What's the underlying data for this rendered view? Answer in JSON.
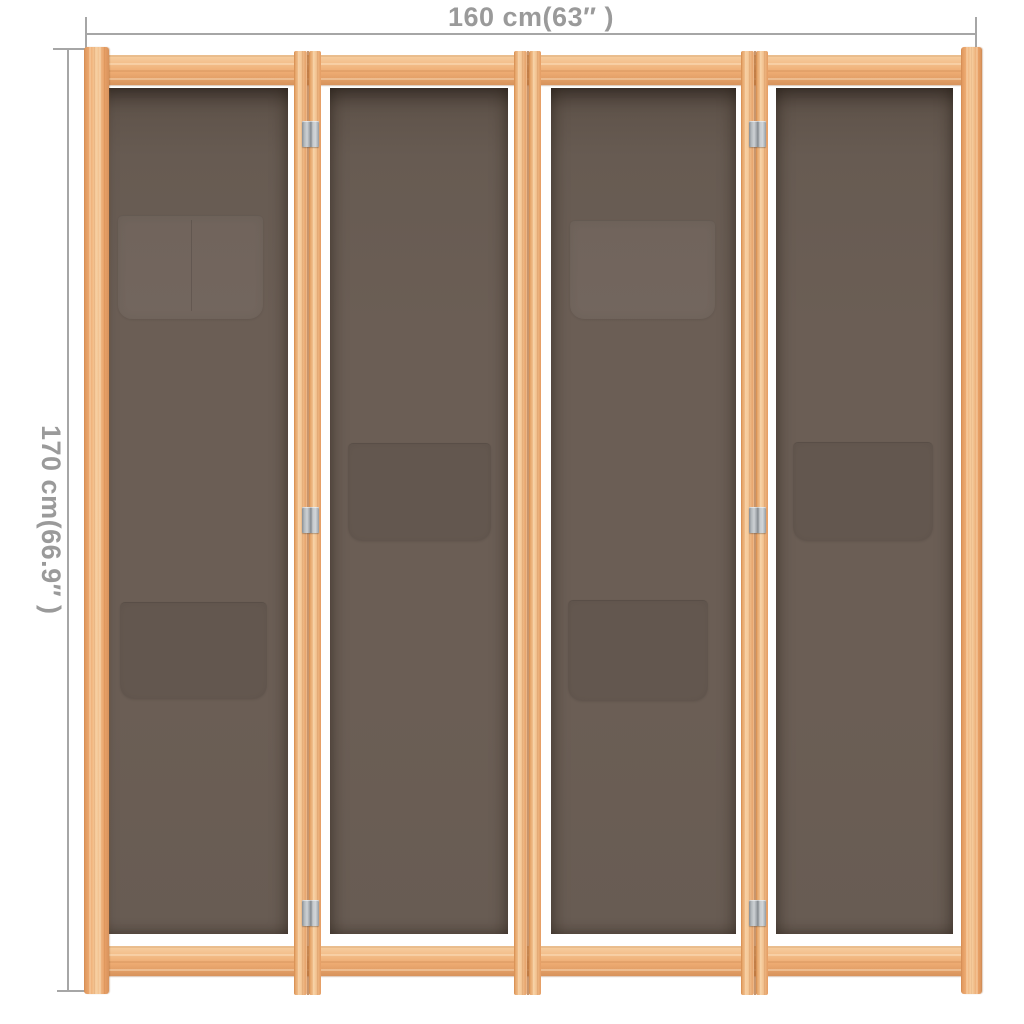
{
  "image": {
    "background": "#ffffff",
    "subject": "4-panel fabric room divider with wooden frame, front view with dimension annotations"
  },
  "dimensions": {
    "width_label": "160 cm(63″ )",
    "height_label": "170 cm(66.9″ )"
  },
  "divider": {
    "panel_count": 4,
    "panels": [
      {
        "id": 1,
        "pockets": [
          "double pocket upper",
          "single pocket lower"
        ]
      },
      {
        "id": 2,
        "pockets": [
          "single pocket middle"
        ]
      },
      {
        "id": 3,
        "pockets": [
          "single pocket upper",
          "single pocket lower"
        ]
      },
      {
        "id": 4,
        "pockets": [
          "single pocket middle"
        ]
      }
    ],
    "visible_hinge_count": 6
  },
  "colors": {
    "background": "#ffffff",
    "dimension_line": "#a6a6a6",
    "dimension_text": "#9a9a9a",
    "wood_light": "#f7d0a2",
    "wood_mid": "#efad74",
    "wood_dark": "#d8935c",
    "wood_seam": "#b4713c",
    "fabric": "#6b5e55",
    "fabric_shadow": "#564b43",
    "hinge": "#cdd1d4"
  }
}
